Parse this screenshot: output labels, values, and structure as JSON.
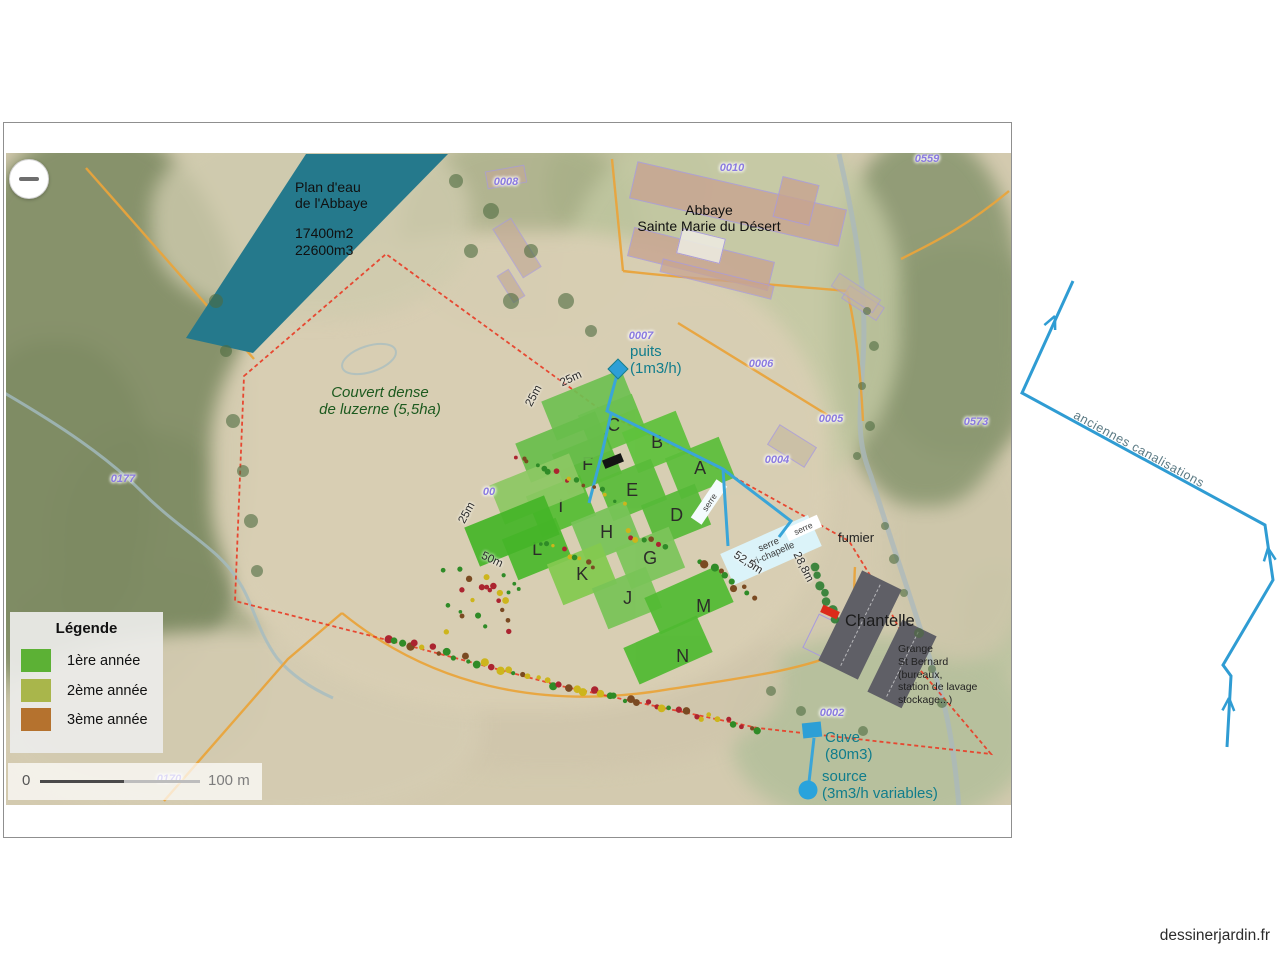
{
  "page": {
    "watermark": "dessinerjardin.fr"
  },
  "map": {
    "zoom_out_label": "−",
    "water_label": {
      "l1": "Plan d'eau",
      "l2": "de l'Abbaye",
      "l3": "17400m2",
      "l4": "22600m3"
    },
    "abbey_label": {
      "l1": "Abbaye",
      "l2": "Sainte Marie du Désert"
    },
    "couvert_label": {
      "l1": "Couvert dense",
      "l2": "de luzerne (5,5ha)"
    },
    "puits_label": {
      "l1": "puits",
      "l2": "(1m3/h)"
    },
    "cuve_label": {
      "l1": "Cuve",
      "l2": "(80m3)"
    },
    "source_label": {
      "l1": "source",
      "l2": "(3m3/h variables)"
    },
    "fumier_label": "fumier",
    "chantelle_label": "Chantelle",
    "grange_label": {
      "l1": "Grange",
      "l2": "St Bernard",
      "l3": "(bureaux,",
      "l4": "station de lavage",
      "l5": "stockage...)"
    },
    "serre_main_label": {
      "l1": "serre",
      "l2": "tri-chapelle"
    },
    "serre_small_label": "serre",
    "serre_corner_label": "serre",
    "canal_label": "anciennes canalisations",
    "parcels": [
      "0008",
      "0010",
      "0559",
      "0007",
      "0006",
      "0005",
      "0004",
      "0573",
      "0177",
      "0002",
      "0170",
      "00"
    ],
    "plots": [
      {
        "label": "C",
        "color": "#63c140"
      },
      {
        "label": "B",
        "color": "#5fc23c"
      },
      {
        "label": "A",
        "color": "#5cbe3b"
      },
      {
        "label": "F",
        "color": "#56ba38"
      },
      {
        "label": "E",
        "color": "#5abc3a"
      },
      {
        "label": "D",
        "color": "#57ba39"
      },
      {
        "label": "I",
        "color": "#55bd33"
      },
      {
        "label": "H",
        "color": "#78c458"
      },
      {
        "label": "G",
        "color": "#7cc55a"
      },
      {
        "label": "L",
        "color": "#4cb92d"
      },
      {
        "label": "K",
        "color": "#84ca50"
      },
      {
        "label": "J",
        "color": "#79c457"
      },
      {
        "label": "M",
        "color": "#52bb33"
      },
      {
        "label": "N",
        "color": "#50ba31"
      },
      {
        "label": "",
        "color": "#6fbf52"
      },
      {
        "label": "",
        "color": "#68bd4b"
      },
      {
        "label": "",
        "color": "#8cc763"
      },
      {
        "label": "",
        "color": "#45b528"
      }
    ],
    "measurements": [
      "25m",
      "25m",
      "25m",
      "50m",
      "52,5m",
      "28,8m"
    ],
    "water_color": "#25798c",
    "pipe_color": "#3aa5d8",
    "boundary_color": "#e8402a"
  },
  "legend": {
    "title": "Légende",
    "items": [
      {
        "label": "1ère année",
        "color": "#5cb135"
      },
      {
        "label": "2ème année",
        "color": "#a9b64b"
      },
      {
        "label": "3ème année",
        "color": "#b5722e"
      }
    ]
  },
  "scalebar": {
    "start": "0",
    "end": "100 m"
  }
}
